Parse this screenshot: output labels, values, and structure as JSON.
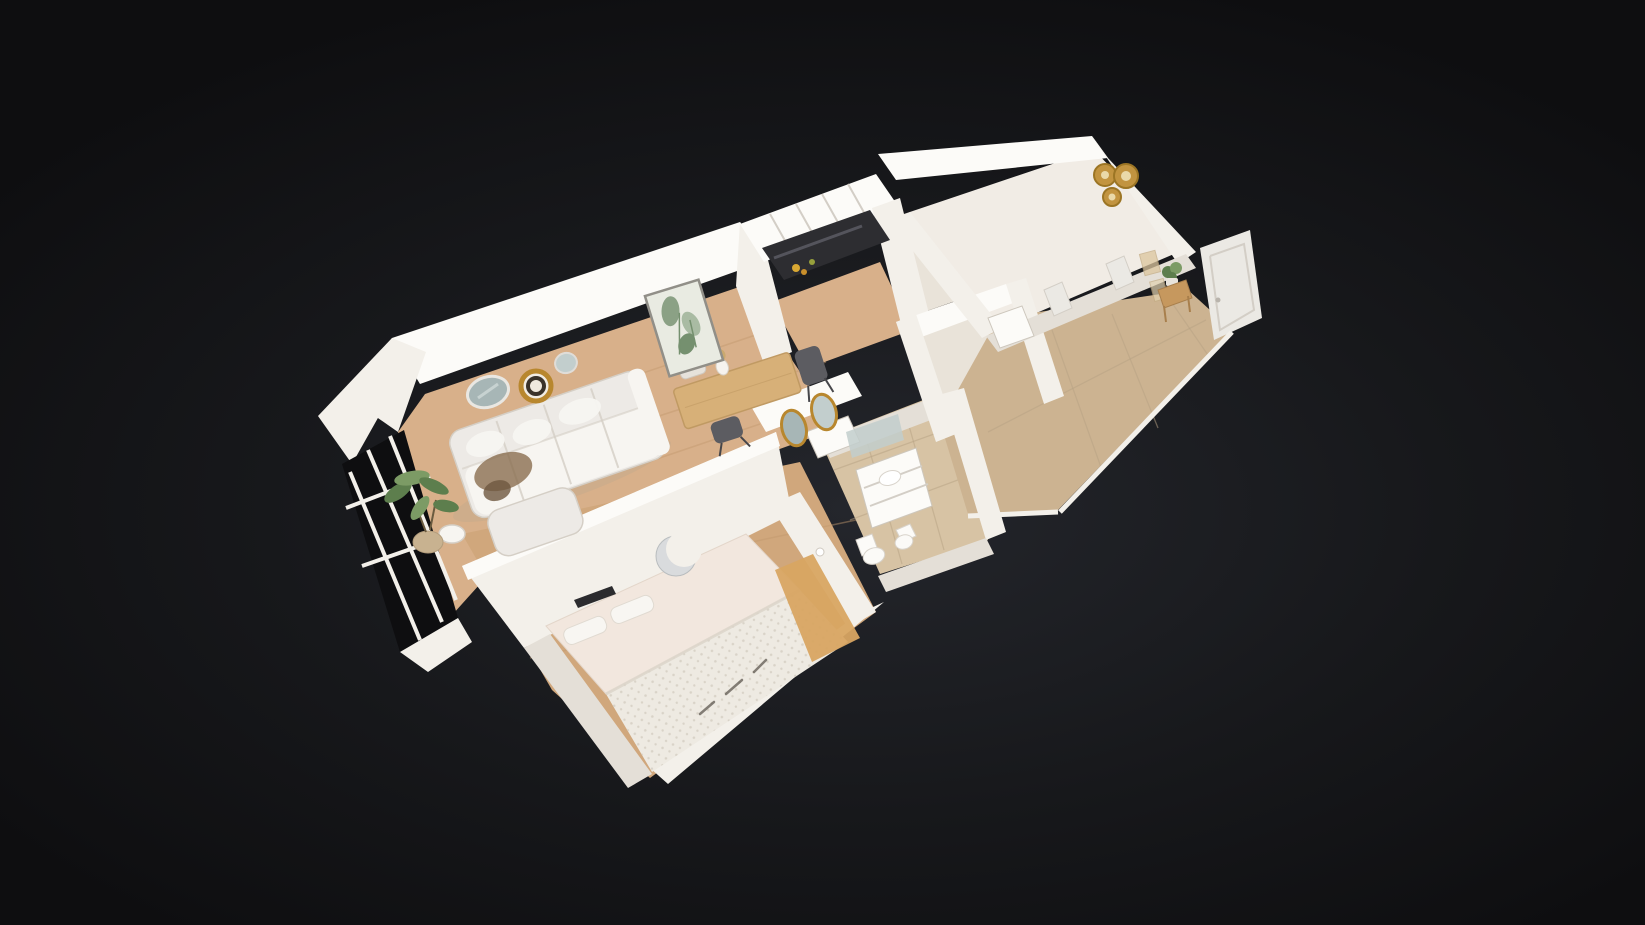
{
  "app": {
    "label": "3D dollhouse view of an apartment floor plan on a dark background",
    "view_mode": "dollhouse",
    "camera": "high-angle three-quarter top-down, model rotated about 18 degrees",
    "visible_ui_chrome": "none"
  },
  "scene": {
    "label": "Cutaway 3D scan of a one-bedroom apartment (white walls, wood and beige tile floors)",
    "colors": {
      "bg_center": "#24262c",
      "bg_mid": "#17181b",
      "bg_edge": "#0e0e10",
      "wall": "#f3f0ea",
      "wall_bright": "#fcfbf8",
      "wall_dim": "#e4dfd7",
      "wall_shadow": "#cdc7bd",
      "floor_wood": "#d8b08a",
      "floor_wood_deep": "#c2996e",
      "floor_bedroom": "#d0a77c",
      "tile": "#d7c3a4",
      "tile_warm": "#ccb391",
      "tile_line": "#b7a284",
      "pale_floor": "#e9e3d9",
      "room_white": "#f1ece5",
      "counter": "#2d2d31",
      "counter_hi": "#595961",
      "sofa": "#edeae6",
      "sofa_hi": "#f7f5f1",
      "sofa_shadow": "#d5cfc6",
      "throw": "#8a6e50",
      "bed_sheet": "#f2e7de",
      "blanket": "#eeeae2",
      "blanket_dot": "#d9d3c8",
      "bed_wood": "#d8a562",
      "rug": "#cda468",
      "rug_ring": "#b78f52",
      "gold": "#b8872e",
      "plate_gold": "#c29440",
      "plate_gold_dark": "#9c7524",
      "plate_inner": "#ead9a9",
      "mirror_glass": "#a7b6b6",
      "mirror_glass_light": "#c2cecd",
      "chrome": "#c7cacc",
      "plant": "#5d7e4d",
      "plant_light": "#7c9b65",
      "pot": "#c8b290",
      "art_bg": "#e9ebe2",
      "art_leaf": "#8ba185",
      "art_leaf_dark": "#75906f",
      "frame": "#918f88",
      "glass_dark": "#0e0e10",
      "door": "#ebe9e4",
      "door_line": "#d3cec6",
      "wood_decor": "#c6985e",
      "table_wood": "#d7b078",
      "fruit": "#d9a833"
    },
    "rooms": [
      {
        "id": "living-room",
        "floor": "wood",
        "items": [
          "white corner sofa",
          "taupe throw blanket",
          "round side table",
          "potted plant",
          "large round wall mirror",
          "gold rimmed wall plate",
          "small round mirror",
          "framed botanical art"
        ]
      },
      {
        "id": "dining-area",
        "floor": "wood",
        "items": [
          "wooden dining table",
          "vase with dried flowers",
          "two dark chairs",
          "light chair",
          "white sideboard",
          "pair of gold oval wall mirrors"
        ]
      },
      {
        "id": "kitchen",
        "floor": "wood",
        "items": [
          "white cabinet run",
          "dark countertop",
          "fruit on counter"
        ]
      },
      {
        "id": "bedroom",
        "floor": "wood",
        "items": [
          "double bed with textured duvet",
          "two pillows",
          "wooden bedside bench",
          "round jute rug",
          "chrome crescent wall decor",
          "wall-mounted TV"
        ]
      },
      {
        "id": "bathroom",
        "floor": "beige tile",
        "items": [
          "white vanity with basin",
          "wall mirror",
          "toilet",
          "bidet"
        ]
      },
      {
        "id": "utility-room",
        "floor": "pale tile",
        "items": [
          "white basin unit"
        ]
      },
      {
        "id": "bedroom-2",
        "floor": "white",
        "items": [
          "three gold wall plates",
          "white fitted interior"
        ]
      },
      {
        "id": "entrance-hall",
        "floor": "beige tile",
        "items": [
          "white front door",
          "wooden console with plant",
          "small picture frames",
          "two interior doors"
        ]
      },
      {
        "id": "balcony",
        "floor": "none",
        "items": [
          "dark glazed French windows with white frames"
        ]
      }
    ]
  }
}
